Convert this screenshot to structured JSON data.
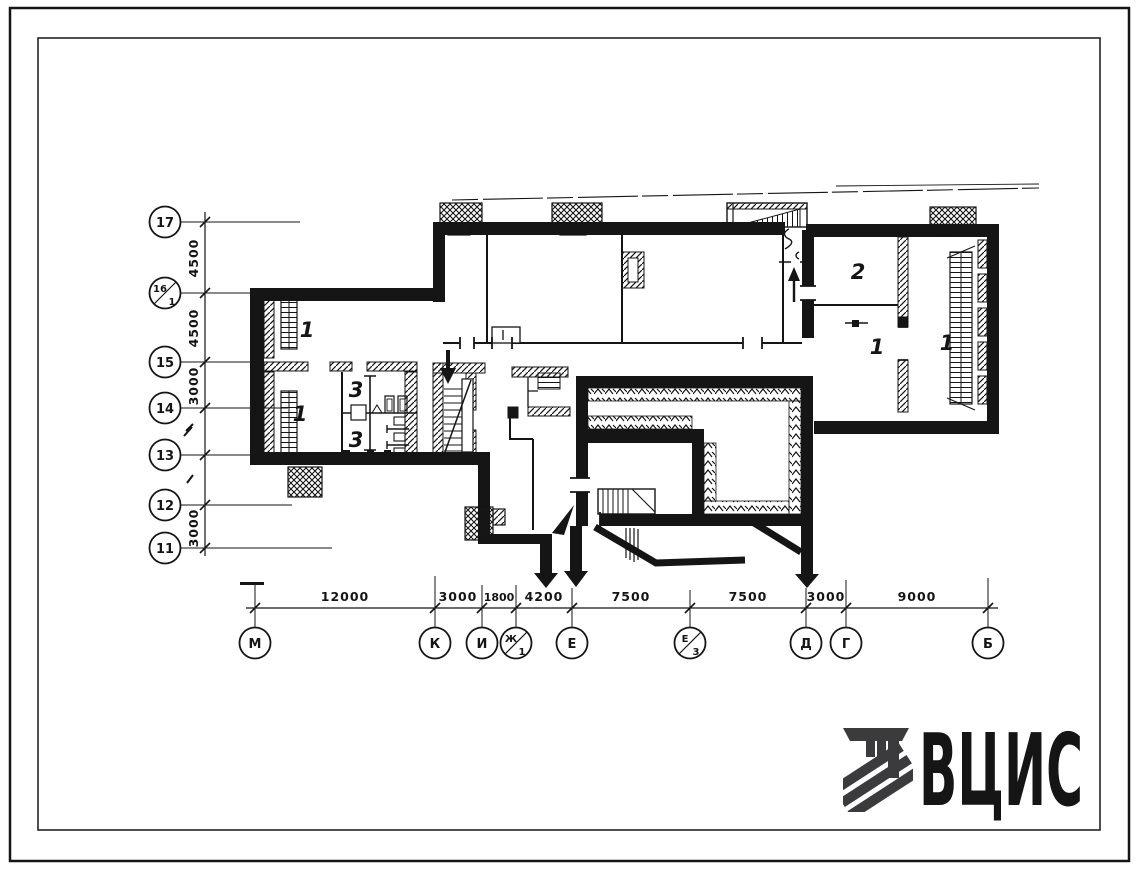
{
  "sheet": {
    "background": "#ffffff",
    "ink": "#151515"
  },
  "logo": {
    "text": "ВЦИС",
    "color": "#3b3b3d",
    "mark": "vcis-emblem"
  },
  "plan": {
    "rooms": [
      "1",
      "1",
      "3",
      "3",
      "2",
      "1",
      "1"
    ]
  },
  "axes": {
    "left": {
      "items": [
        [
          "17"
        ],
        [
          "16",
          "1"
        ],
        [
          "15"
        ],
        [
          "14"
        ],
        [
          "13"
        ],
        [
          "12"
        ],
        [
          "11"
        ]
      ],
      "dims": [
        "4500",
        "4500",
        "3000",
        "3000"
      ],
      "unlabeled_intervals": [
        "14-13",
        "13-12"
      ]
    },
    "bottom": {
      "items": [
        [
          "М"
        ],
        [
          "К"
        ],
        [
          "И"
        ],
        [
          "Ж",
          "1"
        ],
        [
          "Е"
        ],
        [
          "Е",
          "3"
        ],
        [
          "Д"
        ],
        [
          "Г"
        ],
        [
          "Б"
        ]
      ],
      "dims": [
        "12000",
        "3000",
        "1800",
        "4200",
        "7500",
        "7500",
        "3000",
        "9000"
      ]
    }
  }
}
